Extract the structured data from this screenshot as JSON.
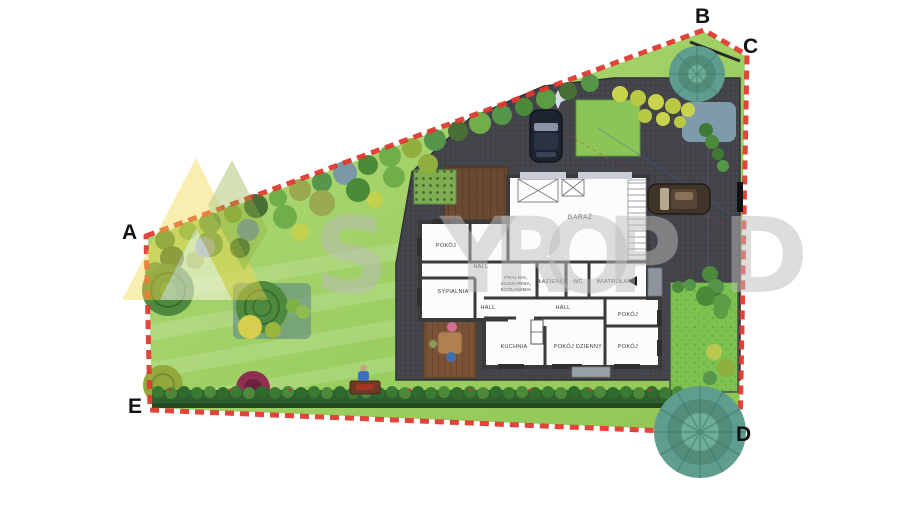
{
  "plan": {
    "corners": {
      "a": "A",
      "b": "B",
      "c": "C",
      "d": "D",
      "e": "E"
    },
    "rooms": {
      "garaz": "GARAŻ",
      "pokoj_nw": "POKÓJ",
      "hall_1": "HALL",
      "sypialnia": "SYPIALNIA",
      "hall_2": "HALL",
      "pralnia_1": "PRALNIA,",
      "pralnia_2": "SUSZARNIA,",
      "pralnia_3": "KOTŁOWNIA",
      "lazienka": "ŁAZIENKA",
      "wc": "WC",
      "wiatrolap": "WIATROŁAP",
      "hall_3": "HALL",
      "pokoj_e1": "POKÓJ",
      "pokoj_e2": "POKÓJ",
      "kuchnia": "KUCHNIA",
      "pokoj_dzienny": "POKÓJ DZIENNY"
    },
    "watermark": {
      "l1": "S",
      "l2": "Y",
      "l3": "R",
      "l4": "O",
      "l5": "P",
      "l6": "D"
    },
    "colors": {
      "boundary": "#e0392f",
      "wall": "#3a3a3a",
      "paving": "#45464c",
      "lawn_light": "#b5da7d",
      "lawn": "#8fc753",
      "lawn_bright": "#7dc24f",
      "watermark": "#bdbdbd",
      "logo_yellow": "#f2d64b",
      "logo_green": "#8fae3e",
      "label": "#3a3a3a"
    }
  }
}
